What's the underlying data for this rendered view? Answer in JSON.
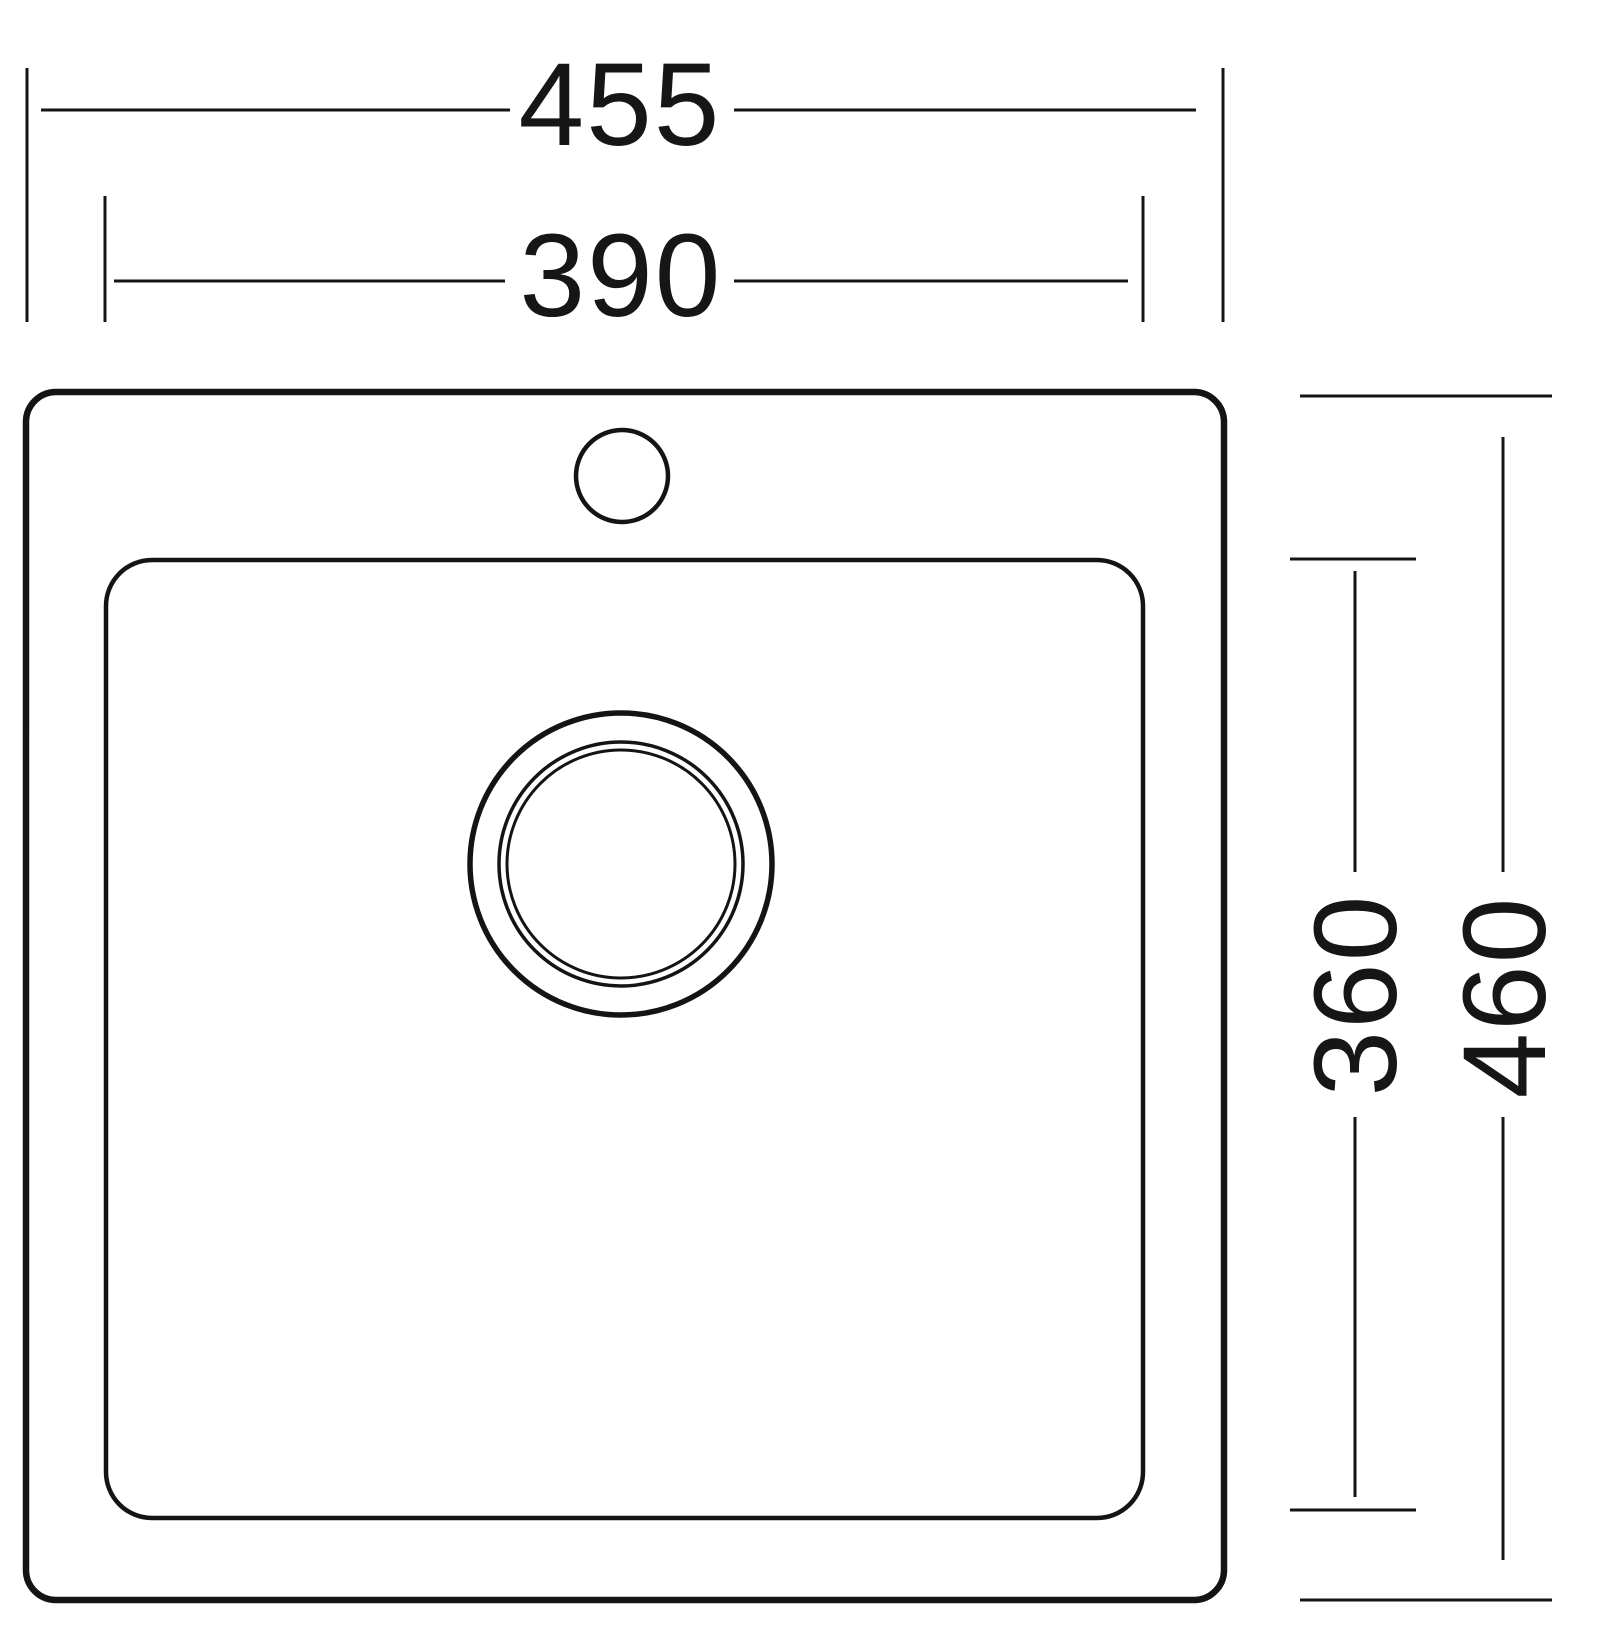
{
  "drawing": {
    "kind": "sink-top-view-dimension-drawing",
    "colors": {
      "line": "#141414",
      "background": "#ffffff"
    },
    "dims": {
      "overall_width": "455",
      "basin_width": "390",
      "basin_depth": "360",
      "overall_depth": "460"
    }
  }
}
